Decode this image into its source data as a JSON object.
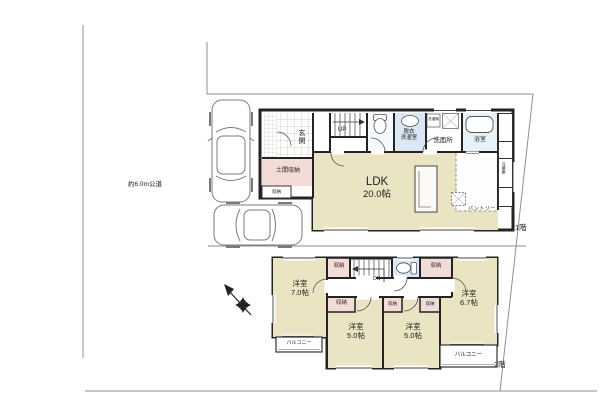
{
  "site": {
    "road_label": "約6.0m公道",
    "floor1_label": "1階",
    "floor2_label": "2階"
  },
  "floor1": {
    "ldk_name": "LDK",
    "ldk_size": "20.0帖",
    "genkan": "玄関",
    "doma": "土間収納",
    "closet": "収納",
    "stairs_up": "UP",
    "datsui_1": "脱衣",
    "datsui_2": "洗濯室",
    "senmenjo": "洗面所",
    "bath": "浴室",
    "washer": "洗濯機",
    "fridge": "冷蔵庫",
    "pantry": "パントリー"
  },
  "floor2": {
    "room1_name": "洋室",
    "room1_size": "7.0帖",
    "room2_name": "洋室",
    "room2_size": "6.7帖",
    "room3_name": "洋室",
    "room3_size": "5.0帖",
    "room4_name": "洋室",
    "room4_size": "5.0帖",
    "closet": "収納",
    "stairs_down": "DN",
    "balcony": "バルコニー"
  },
  "colors": {
    "room_floor": "#eae4c3",
    "closet_pink": "#f3dbd7",
    "toilet_blue": "#dbe7f4",
    "bath_blue": "#e9f1f8",
    "wall": "#232323",
    "site_line": "#8f8f8f"
  }
}
